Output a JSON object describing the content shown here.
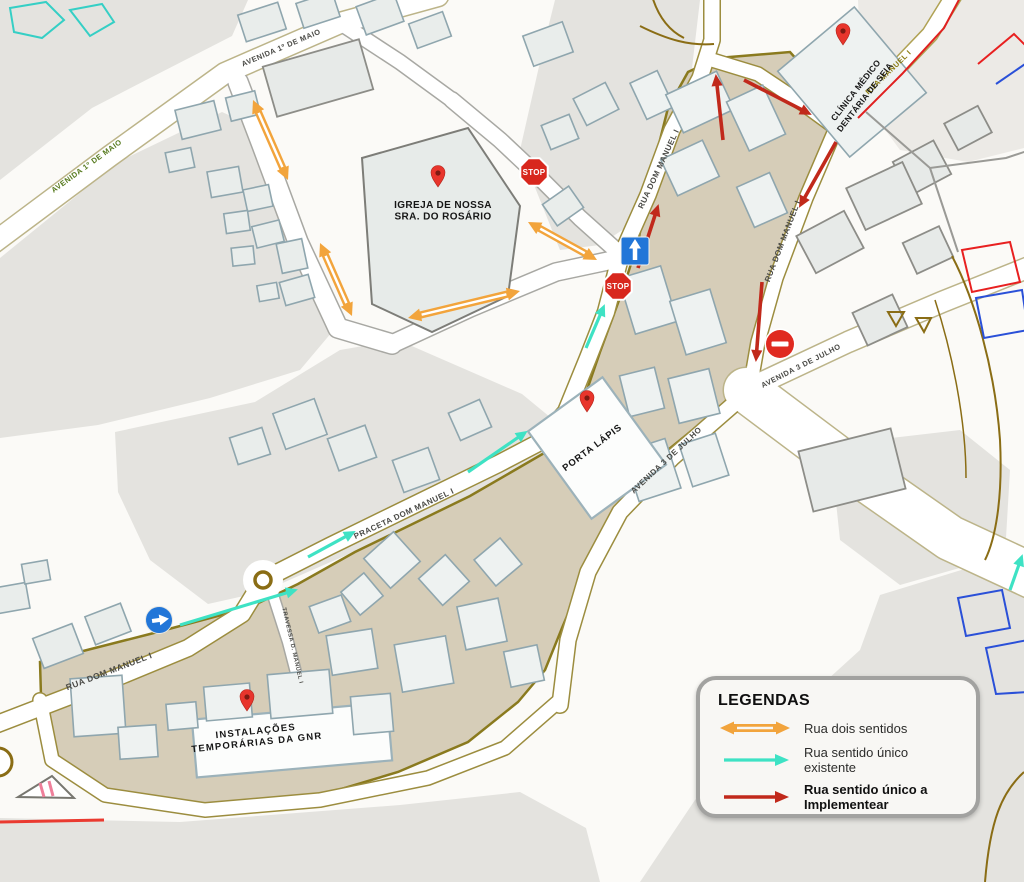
{
  "colors": {
    "two_way": "#F2A43C",
    "one_way_existing": "#3EE2C4",
    "one_way_new": "#C1291B",
    "stop_red": "#D8271D",
    "no_entry_red": "#E02A20",
    "sign_blue": "#2276D8",
    "pin_red": "#E8352C",
    "zone_fill": "#D6CDB8",
    "zone_border": "#8A7A1E"
  },
  "legend": {
    "title": "LEGENDAS",
    "items": [
      {
        "id": "two_way",
        "label": "Rua dois sentidos"
      },
      {
        "id": "one_way_existing",
        "label": "Rua sentido único existente"
      },
      {
        "id": "one_way_new",
        "label": "Rua sentido único a\nImplementear"
      }
    ]
  },
  "map": {
    "pois": [
      {
        "id": "igreja",
        "lines": [
          "IGREJA DE NOSSA",
          "SRA. DO ROSÁRIO"
        ],
        "x": 443,
        "y": 208,
        "rot": 0,
        "size": 10,
        "spacing": 0.4,
        "pin": {
          "x": 438,
          "y": 186
        }
      },
      {
        "id": "porta-lapis",
        "lines": [
          "PORTA LÁPIS"
        ],
        "x": 594,
        "y": 450,
        "rot": -37,
        "size": 9.5,
        "spacing": 0.8,
        "pin": {
          "x": 587,
          "y": 411
        }
      },
      {
        "id": "gnr",
        "lines": [
          "INSTALAÇÕES",
          "TEMPORÁRIAS DA GNR"
        ],
        "x": 256,
        "y": 734,
        "rot": -6,
        "size": 9.5,
        "spacing": 1.2,
        "pin": {
          "x": 247,
          "y": 710
        }
      },
      {
        "id": "clinica",
        "lines": [
          "CLÍNICA MÉDICO",
          "DENTÁRIA DE SEIA"
        ],
        "x": 858,
        "y": 92,
        "rot": -52,
        "size": 8.5,
        "spacing": 0.3,
        "pin": {
          "x": 843,
          "y": 44
        }
      }
    ],
    "street_labels": [
      {
        "text": "AVENIDA 1º DE MAIO",
        "x": 88,
        "y": 168,
        "rot": -36,
        "color": "#55791C",
        "size": 7.5
      },
      {
        "text": "AVENIDA 1º DE MAIO",
        "x": 282,
        "y": 50,
        "rot": -23,
        "color": "#4A4A46",
        "size": 7.5
      },
      {
        "text": "RUA DOM MANUEL I",
        "x": 661,
        "y": 170,
        "rot": -65,
        "color": "#4A4A46",
        "size": 8
      },
      {
        "text": "RUA DOM MANUEL I",
        "x": 785,
        "y": 242,
        "rot": -69,
        "color": "#4A4A46",
        "size": 8
      },
      {
        "text": "RUA MANUEL I",
        "x": 890,
        "y": 74,
        "rot": -44,
        "color": "#8A7A10",
        "size": 7.5
      },
      {
        "text": "RUA DOM MANUEL I",
        "x": 110,
        "y": 674,
        "rot": -21,
        "color": "#4A4A46",
        "size": 8.5
      },
      {
        "text": "PRACETA DOM MANUEL I",
        "x": 405,
        "y": 516,
        "rot": -25,
        "color": "#4A4A46",
        "size": 8
      },
      {
        "text": "TRAVESSA D. MANUEL I",
        "x": 291,
        "y": 646,
        "rot": 77,
        "color": "#4A4A46",
        "size": 5.8
      },
      {
        "text": "AVENIDA 3 DE JULHO",
        "x": 802,
        "y": 368,
        "rot": -27,
        "color": "#4A4A46",
        "size": 7.5
      },
      {
        "text": "AVENIDA 3 DE JULHO",
        "x": 668,
        "y": 462,
        "rot": -43,
        "color": "#4A4A46",
        "size": 8
      }
    ],
    "signs": [
      {
        "type": "stop",
        "label": "STOP",
        "x": 534,
        "y": 172
      },
      {
        "type": "stop",
        "label": "STOP",
        "x": 618,
        "y": 286
      },
      {
        "type": "one_way_up",
        "x": 635,
        "y": 251
      },
      {
        "type": "mandatory_right",
        "x": 159,
        "y": 620
      },
      {
        "type": "no_entry",
        "x": 780,
        "y": 344
      }
    ],
    "arrows": [
      {
        "type": "two_way",
        "points": [
          [
            253,
            100
          ],
          [
            288,
            180
          ]
        ]
      },
      {
        "type": "two_way",
        "points": [
          [
            320,
            243
          ],
          [
            352,
            316
          ]
        ]
      },
      {
        "type": "two_way",
        "points": [
          [
            408,
            318
          ],
          [
            520,
            291
          ]
        ]
      },
      {
        "type": "two_way",
        "points": [
          [
            528,
            222
          ],
          [
            597,
            260
          ]
        ]
      },
      {
        "type": "one_way_existing",
        "points": [
          [
            180,
            625
          ],
          [
            296,
            590
          ]
        ]
      },
      {
        "type": "one_way_existing",
        "points": [
          [
            308,
            557
          ],
          [
            354,
            532
          ]
        ]
      },
      {
        "type": "one_way_existing",
        "points": [
          [
            468,
            472
          ],
          [
            526,
            432
          ]
        ]
      },
      {
        "type": "one_way_existing",
        "points": [
          [
            586,
            348
          ],
          [
            604,
            306
          ]
        ]
      },
      {
        "type": "one_way_existing",
        "points": [
          [
            1010,
            590
          ],
          [
            1022,
            556
          ]
        ]
      },
      {
        "type": "one_way_new",
        "points": [
          [
            638,
            268
          ],
          [
            658,
            206
          ]
        ]
      },
      {
        "type": "one_way_new",
        "points": [
          [
            723,
            140
          ],
          [
            716,
            76
          ]
        ]
      },
      {
        "type": "one_way_new",
        "points": [
          [
            744,
            80
          ],
          [
            810,
            114
          ]
        ]
      },
      {
        "type": "one_way_new",
        "points": [
          [
            836,
            142
          ],
          [
            800,
            206
          ]
        ]
      },
      {
        "type": "one_way_new",
        "points": [
          [
            762,
            282
          ],
          [
            756,
            360
          ]
        ]
      }
    ]
  }
}
